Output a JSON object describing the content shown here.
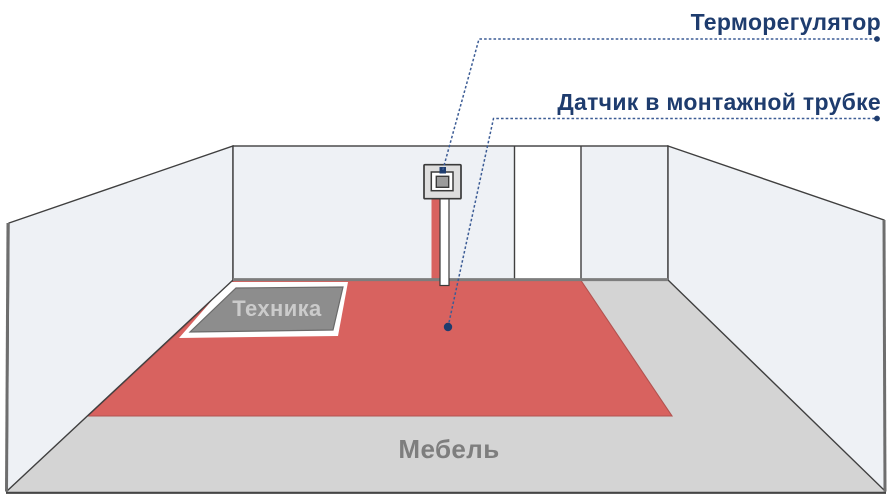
{
  "diagram": {
    "type": "underfloor-heating-room-scheme",
    "labels": {
      "thermostat": "Терморегулятор",
      "sensor": "Датчик в монтажной трубке",
      "appliance_zone": "Техника",
      "furniture_zone": "Мебель"
    },
    "colors": {
      "wall": "#eef1f5",
      "floor": "#d4d4d4",
      "heated_floor": "#d8625f",
      "heated_floor_edge": "#b25350",
      "unheated_cutout": "#ffffff",
      "appliance_block": "#8d8d8d",
      "appliance_text": "#cbcbcb",
      "furniture_text": "#7e7e7e",
      "label_text": "#1e3c6e",
      "callout_line": "#3c5c95",
      "callout_dot": "#1e3c6e",
      "door": "#ffffff",
      "thermostat_body": "#dedede",
      "thermostat_frame": "#ffffff",
      "thermostat_screen": "#9b9b9b",
      "heating_cable": "#d8625f",
      "sensor_tube": "#ffffff"
    }
  }
}
